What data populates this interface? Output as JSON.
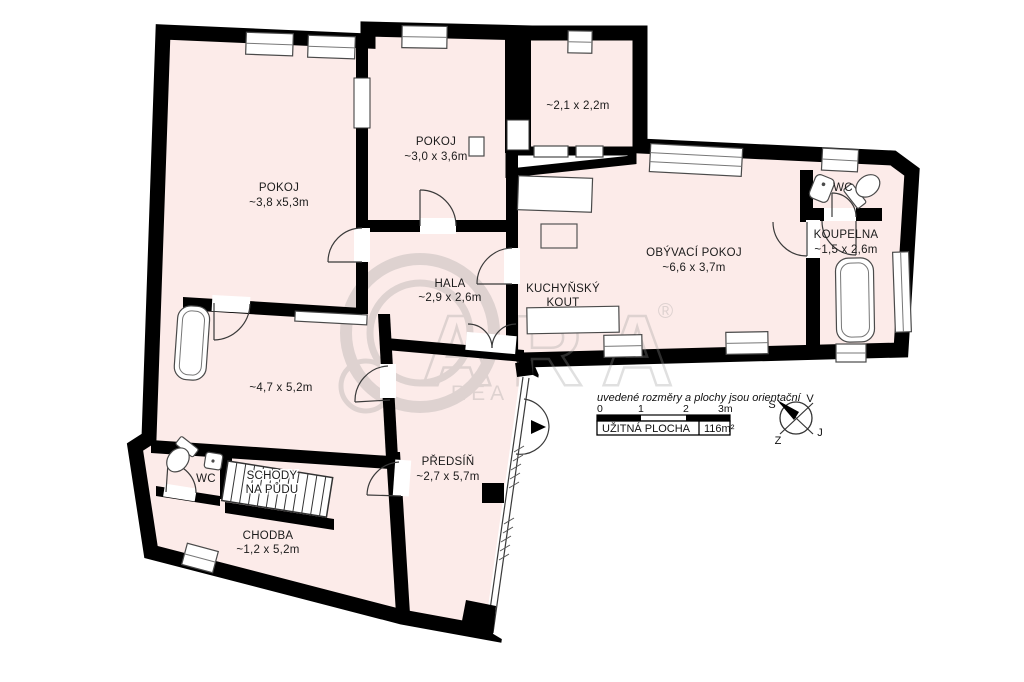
{
  "colors": {
    "floor": "#fcebe9",
    "wall": "#000000",
    "line": "#3a3a3a",
    "background": "#ffffff"
  },
  "rooms": [
    {
      "id": "pokoj-1",
      "name": "POKOJ",
      "dims": "~3,8 x5,3m"
    },
    {
      "id": "pokoj-2",
      "name": "POKOJ",
      "dims": "~3,0 x 3,6m"
    },
    {
      "id": "room-small",
      "name": "",
      "dims": "~2,1 x 2,2m"
    },
    {
      "id": "obyvaci-pokoj",
      "name": "OBÝVACÍ POKOJ",
      "dims": "~6,6 x 3,7m"
    },
    {
      "id": "kuchynsky-kout",
      "name": "KUCHYŇSKÝ",
      "name2": "KOUT"
    },
    {
      "id": "koupelna",
      "name": "KOUPELNA",
      "dims": "~1,5 x 2,6m"
    },
    {
      "id": "wc-top",
      "name": "WC"
    },
    {
      "id": "hala",
      "name": "HALA",
      "dims": "~2,9 x 2,6m"
    },
    {
      "id": "room-47",
      "name": "",
      "dims": "~4,7 x 5,2m"
    },
    {
      "id": "predsin",
      "name": "PŘEDSÍŇ",
      "dims": "~2,7 x 5,7m"
    },
    {
      "id": "schody",
      "name": "SCHODY",
      "name2": "NA PŮDU"
    },
    {
      "id": "wc-bottom",
      "name": "WC"
    },
    {
      "id": "chodba",
      "name": "CHODBA",
      "dims": "~1,2 x 5,2m"
    }
  ],
  "legend": {
    "note": "uvedené rozměry a plochy jsou orientační",
    "scale": {
      "t0": "0",
      "t1": "1",
      "t2": "2",
      "t3": "3m"
    },
    "area_label": "UŽITNÁ PLOCHA",
    "area_value": "116m²"
  },
  "compass": {
    "top_left": "S",
    "top_right": "V",
    "bottom_right": "J",
    "bottom_left": "Z"
  }
}
